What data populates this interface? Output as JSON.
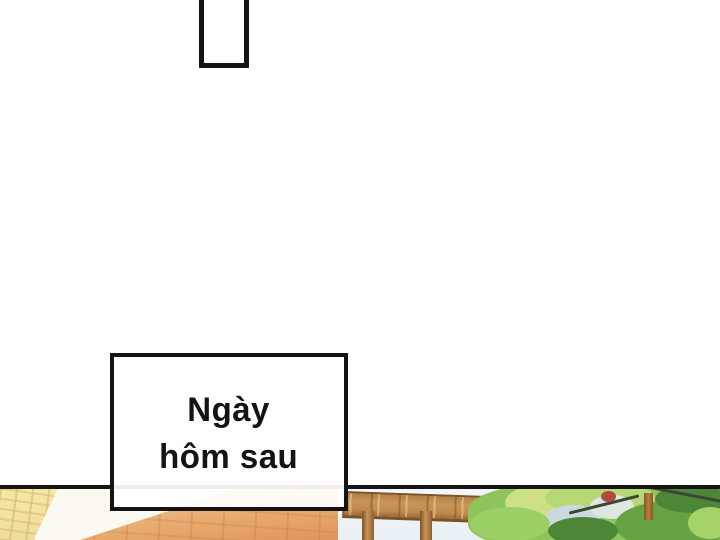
{
  "comic": {
    "caption": {
      "line1": "Ngày",
      "line2": "hôm sau"
    }
  },
  "theme": {
    "ink": "#141414",
    "paper": "#ffffff",
    "brick-yellow": "#f3e9a4",
    "roof-white": "#fbf9f0",
    "tile-orange-light": "#f6d4a8",
    "tile-orange": "#e9ad72",
    "tile-orange-deep": "#df935a",
    "wood": "#c8955a",
    "wood-dark": "#7c5324",
    "sky-gap": "#e9f0f6",
    "leaf-light": "#cde184",
    "leaf-mid": "#8ec45c",
    "leaf-deep": "#66a342",
    "leaf-dark": "#4e8637",
    "branch": "#3a4733",
    "trunk": "#b97f3e",
    "leaf-red": "#b14a3a"
  }
}
